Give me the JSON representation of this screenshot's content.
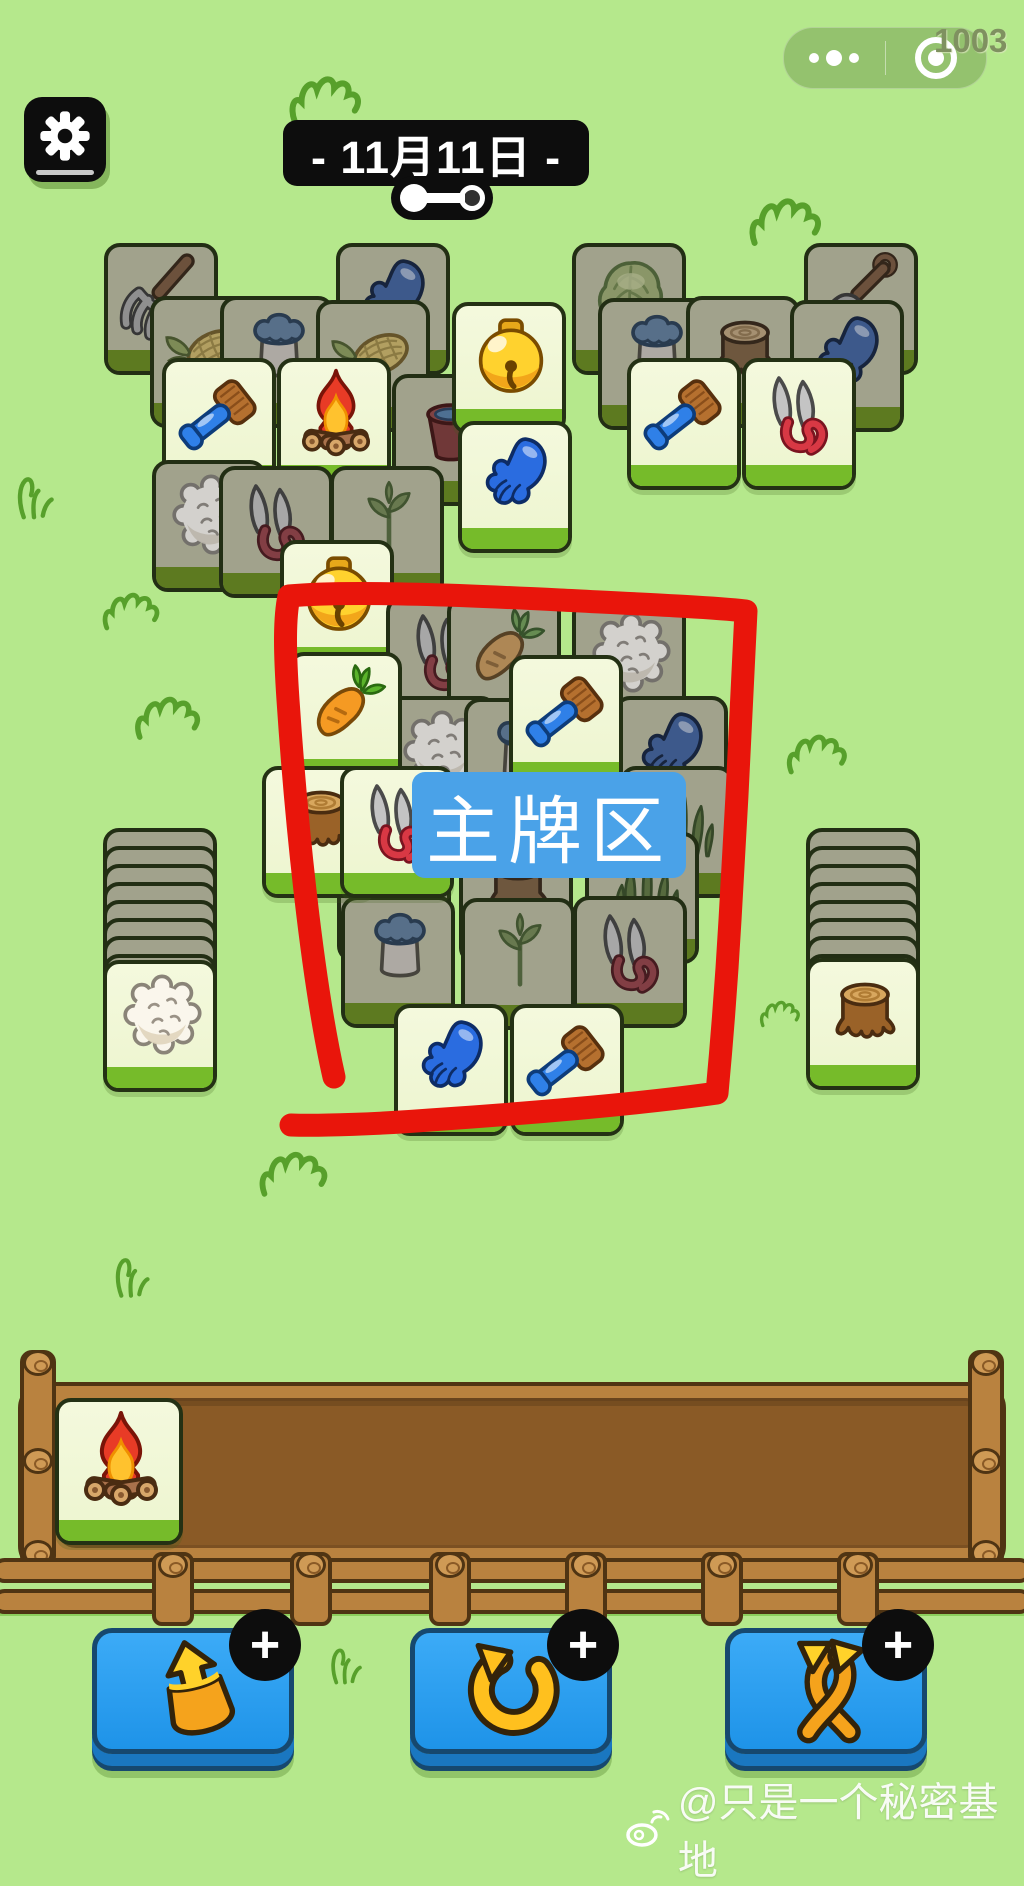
{
  "status_bar": {
    "badge_number": "1003"
  },
  "header": {
    "date_banner": "- 11月11日 -"
  },
  "annotation": {
    "zone_label": "主牌区",
    "line_color": "#e9150b",
    "label_bg": "#4aa2e8"
  },
  "board": {
    "tiles": [
      {
        "icon": "pitchfork",
        "x": 104,
        "y": 243,
        "variant": "covered"
      },
      {
        "icon": "glove",
        "x": 336,
        "y": 243,
        "variant": "covered"
      },
      {
        "icon": "cabbage",
        "x": 572,
        "y": 243,
        "variant": "covered"
      },
      {
        "icon": "shovel",
        "x": 804,
        "y": 243,
        "variant": "covered"
      },
      {
        "icon": "corn",
        "x": 150,
        "y": 296,
        "variant": "covered"
      },
      {
        "icon": "milkcan",
        "x": 220,
        "y": 296,
        "variant": "covered"
      },
      {
        "icon": "corn",
        "x": 316,
        "y": 300,
        "variant": "covered"
      },
      {
        "icon": "milkcan",
        "x": 598,
        "y": 298,
        "variant": "covered"
      },
      {
        "icon": "stump",
        "x": 686,
        "y": 296,
        "variant": "covered"
      },
      {
        "icon": "glove",
        "x": 790,
        "y": 300,
        "variant": "covered"
      },
      {
        "icon": "bucket",
        "x": 392,
        "y": 374,
        "variant": "covered"
      },
      {
        "icon": "bell",
        "x": 452,
        "y": 302,
        "variant": "light"
      },
      {
        "icon": "brush",
        "x": 162,
        "y": 358,
        "variant": "light"
      },
      {
        "icon": "fire",
        "x": 277,
        "y": 358,
        "variant": "light"
      },
      {
        "icon": "brush",
        "x": 627,
        "y": 358,
        "variant": "light"
      },
      {
        "icon": "shears",
        "x": 742,
        "y": 358,
        "variant": "light"
      },
      {
        "icon": "glove",
        "x": 458,
        "y": 421,
        "variant": "light"
      },
      {
        "icon": "wool",
        "x": 152,
        "y": 460,
        "variant": "covered"
      },
      {
        "icon": "shears",
        "x": 219,
        "y": 466,
        "variant": "covered"
      },
      {
        "icon": "plant",
        "x": 330,
        "y": 466,
        "variant": "covered"
      },
      {
        "icon": "bell",
        "x": 280,
        "y": 540,
        "variant": "light"
      },
      {
        "icon": "shears",
        "x": 386,
        "y": 596,
        "variant": "covered"
      },
      {
        "icon": "carrot",
        "x": 447,
        "y": 596,
        "variant": "covered"
      },
      {
        "icon": "wool",
        "x": 572,
        "y": 598,
        "variant": "covered"
      },
      {
        "icon": "wool",
        "x": 383,
        "y": 696,
        "variant": "covered"
      },
      {
        "icon": "milkcan",
        "x": 464,
        "y": 698,
        "variant": "covered"
      },
      {
        "icon": "glove",
        "x": 614,
        "y": 696,
        "variant": "covered"
      },
      {
        "icon": "grass",
        "x": 620,
        "y": 766,
        "variant": "covered"
      },
      {
        "icon": "carrot",
        "x": 288,
        "y": 652,
        "variant": "light"
      },
      {
        "icon": "brush",
        "x": 509,
        "y": 655,
        "variant": "light"
      },
      {
        "icon": "brush",
        "x": 337,
        "y": 830,
        "variant": "covered"
      },
      {
        "icon": "stump",
        "x": 459,
        "y": 832,
        "variant": "covered"
      },
      {
        "icon": "grass",
        "x": 585,
        "y": 832,
        "variant": "covered"
      },
      {
        "icon": "milkcan",
        "x": 341,
        "y": 896,
        "variant": "covered"
      },
      {
        "icon": "plant",
        "x": 461,
        "y": 898,
        "variant": "covered"
      },
      {
        "icon": "shears",
        "x": 573,
        "y": 896,
        "variant": "covered"
      },
      {
        "icon": "stump",
        "x": 262,
        "y": 766,
        "variant": "light"
      },
      {
        "icon": "shears",
        "x": 340,
        "y": 766,
        "variant": "light"
      },
      {
        "icon": "glove",
        "x": 394,
        "y": 1004,
        "variant": "light"
      },
      {
        "icon": "brush",
        "x": 510,
        "y": 1004,
        "variant": "light"
      }
    ]
  },
  "stacks": {
    "left": {
      "x": 103,
      "y": 828,
      "back_layers": 8,
      "layer_offset": 18,
      "front_tile": {
        "icon": "wool",
        "x": 103,
        "y": 960
      }
    },
    "right": {
      "x": 806,
      "y": 828,
      "back_layers": 8,
      "layer_offset": 18,
      "front_tile": {
        "icon": "stump",
        "x": 806,
        "y": 958
      }
    }
  },
  "tray": {
    "slot_tiles": [
      {
        "icon": "fire",
        "x": 55,
        "y": 1398
      }
    ]
  },
  "toolbar": {
    "plus_label": "+",
    "buttons": [
      {
        "name": "move-out",
        "icon": "arrowout",
        "x": 92
      },
      {
        "name": "undo",
        "icon": "undo",
        "x": 410
      },
      {
        "name": "shuffle",
        "icon": "shuffle",
        "x": 725
      }
    ]
  },
  "watermark": {
    "text": "@只是一个秘密基地"
  },
  "colors": {
    "background": "#b5e88c",
    "tile_light": "#f3f9dc",
    "tile_covered": "#a1a28c",
    "tile_band_light": "#76bb2a",
    "tile_band_covered": "#5d7a20",
    "button_blue": "#2a9ef2",
    "annotation_red": "#e9150b",
    "label_blue": "#4aa2e8",
    "tray_wood": "#b9823f",
    "tray_inner": "#8a5a26"
  }
}
